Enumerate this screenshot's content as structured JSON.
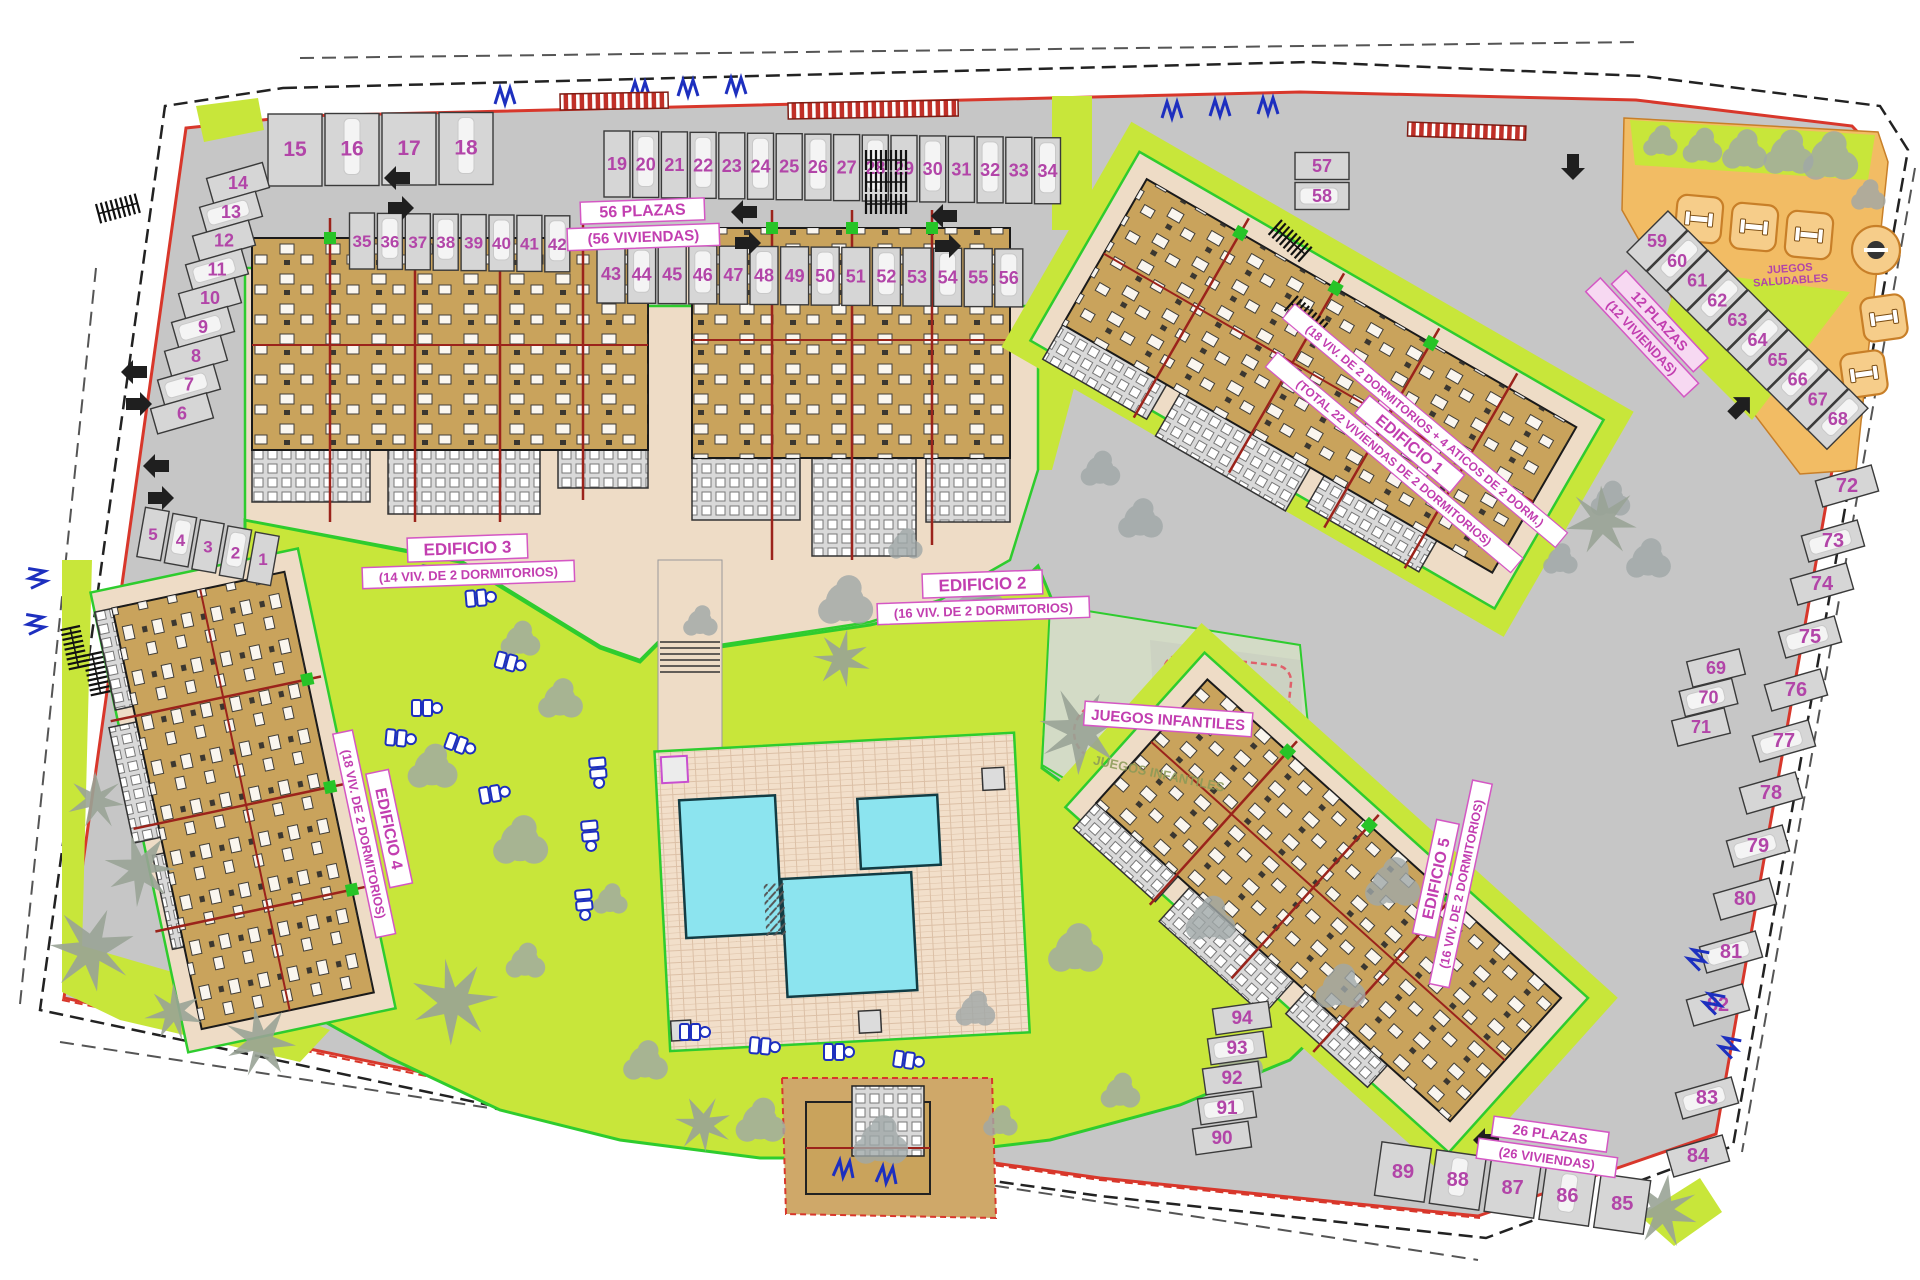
{
  "buildings": [
    {
      "name": "EDIFICIO 1",
      "desc": "(18 VIV. DE 2 DORMITORIOS + 4 ATICOS DE 2 DORM.)",
      "total": "(TOTAL 22 VIVIENDAS DE 2 DORMITORIOS)"
    },
    {
      "name": "EDIFICIO 2",
      "desc": "(16 VIV. DE 2 DORMITORIOS)"
    },
    {
      "name": "EDIFICIO 3",
      "desc": "(14 VIV. DE 2 DORMITORIOS)"
    },
    {
      "name": "EDIFICIO 4",
      "desc": "(18 VIV. DE 2 DORMITORIOS)"
    },
    {
      "name": "EDIFICIO 5",
      "desc": "(16 VIV. DE 2 DORMITORIOS)"
    }
  ],
  "areas": {
    "playground_label": "JUEGOS INFANTILES",
    "playground_label_2": "JUEGOS INFANTILES",
    "fitness_label_1": "JUEGOS",
    "fitness_label_2": "SALUDABLES"
  },
  "parking": {
    "summary_labels": [
      {
        "line1": "56 PLAZAS",
        "line2": "(56 VIVIENDAS)"
      },
      {
        "line1": "12 PLAZAS",
        "line2": "(12 VIVIENDAS)"
      },
      {
        "line1": "26 PLAZAS",
        "line2": "(26 VIVIENDAS)"
      }
    ],
    "groups": {
      "row_top_left": [
        15,
        16,
        17,
        18
      ],
      "row_top": [
        19,
        20,
        21,
        22,
        23,
        24,
        25,
        26,
        27,
        28,
        29,
        30,
        31,
        32,
        33,
        34
      ],
      "row_second_left": [
        35,
        36,
        37,
        38,
        39,
        40,
        41,
        42
      ],
      "row_second": [
        43,
        44,
        45,
        46,
        47,
        48,
        49,
        50,
        51,
        52,
        53,
        54,
        55,
        56
      ],
      "pair_57_58": [
        57,
        58
      ],
      "diag_right": [
        59,
        60,
        61,
        62,
        63,
        64,
        65,
        66,
        67,
        68
      ],
      "mid_right": [
        69,
        70,
        71
      ],
      "col_right": [
        72,
        73,
        74,
        75,
        76,
        77,
        78,
        79,
        80,
        81,
        82,
        83,
        84
      ],
      "row_bottom": [
        89,
        88,
        87,
        86,
        85
      ],
      "col_mid_bottom": [
        94,
        93,
        92,
        91,
        90
      ],
      "col_left": [
        14,
        13,
        12,
        11,
        10,
        9,
        8,
        7,
        6
      ],
      "row_left_small": [
        5,
        4,
        3,
        2,
        1
      ]
    }
  },
  "colors": {
    "road": "#c6c6c6",
    "stall": "#d6d6d6",
    "number_magenta": "#b245a8",
    "label_magenta": "#c23eb0",
    "green": "#c8e63a",
    "outline_green": "#2ecc2e",
    "boundary_red": "#d8372b",
    "building_tan": "#c9a35c",
    "beige": "#eedcc6",
    "pool_cyan": "#8ce4ef",
    "deck": "#f2dfca",
    "orange_zone": "#f2bc64",
    "icon_blue": "#1d2fbf"
  }
}
